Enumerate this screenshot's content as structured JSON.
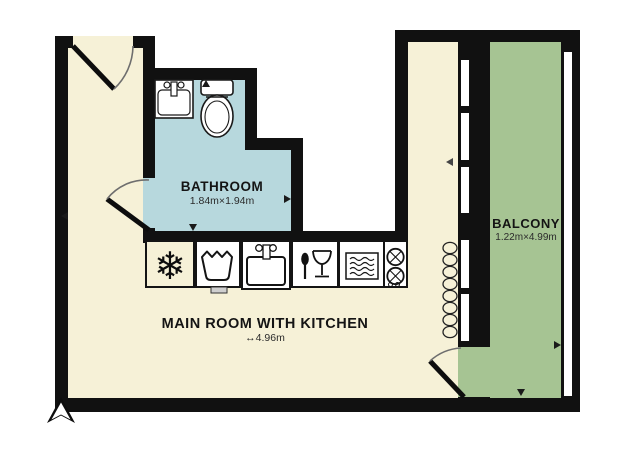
{
  "rooms": {
    "bathroom": {
      "label": "BATHROOM",
      "dimensions": "1.84m×1.94m",
      "fill": "#b7d8dd"
    },
    "main_room": {
      "label": "MAIN ROOM WITH KITCHEN",
      "dimensions": "↔4.96m",
      "fill": "#f6f1d7"
    },
    "balcony": {
      "label": "BALCONY",
      "dimensions": "1.22m×4.99m",
      "fill": "#a6c493"
    }
  },
  "fixtures": {
    "bathroom": [
      "washbasin",
      "toilet"
    ],
    "kitchen": [
      "freezer",
      "washing-machine",
      "sink",
      "dishwasher",
      "microwave-oven",
      "stove"
    ],
    "other": [
      "radiator",
      "north-arrow",
      "entry-door",
      "bathroom-door",
      "balcony-door",
      "windows"
    ]
  },
  "icons": {
    "freezer_glyph": "❄"
  },
  "colors": {
    "wall": "#111111",
    "background": "#ffffff",
    "window": "#ffffff",
    "door_arc": "#6e6e6e",
    "appliance_fill": "#ffffff",
    "appliance_stroke": "#1a1a1a"
  }
}
